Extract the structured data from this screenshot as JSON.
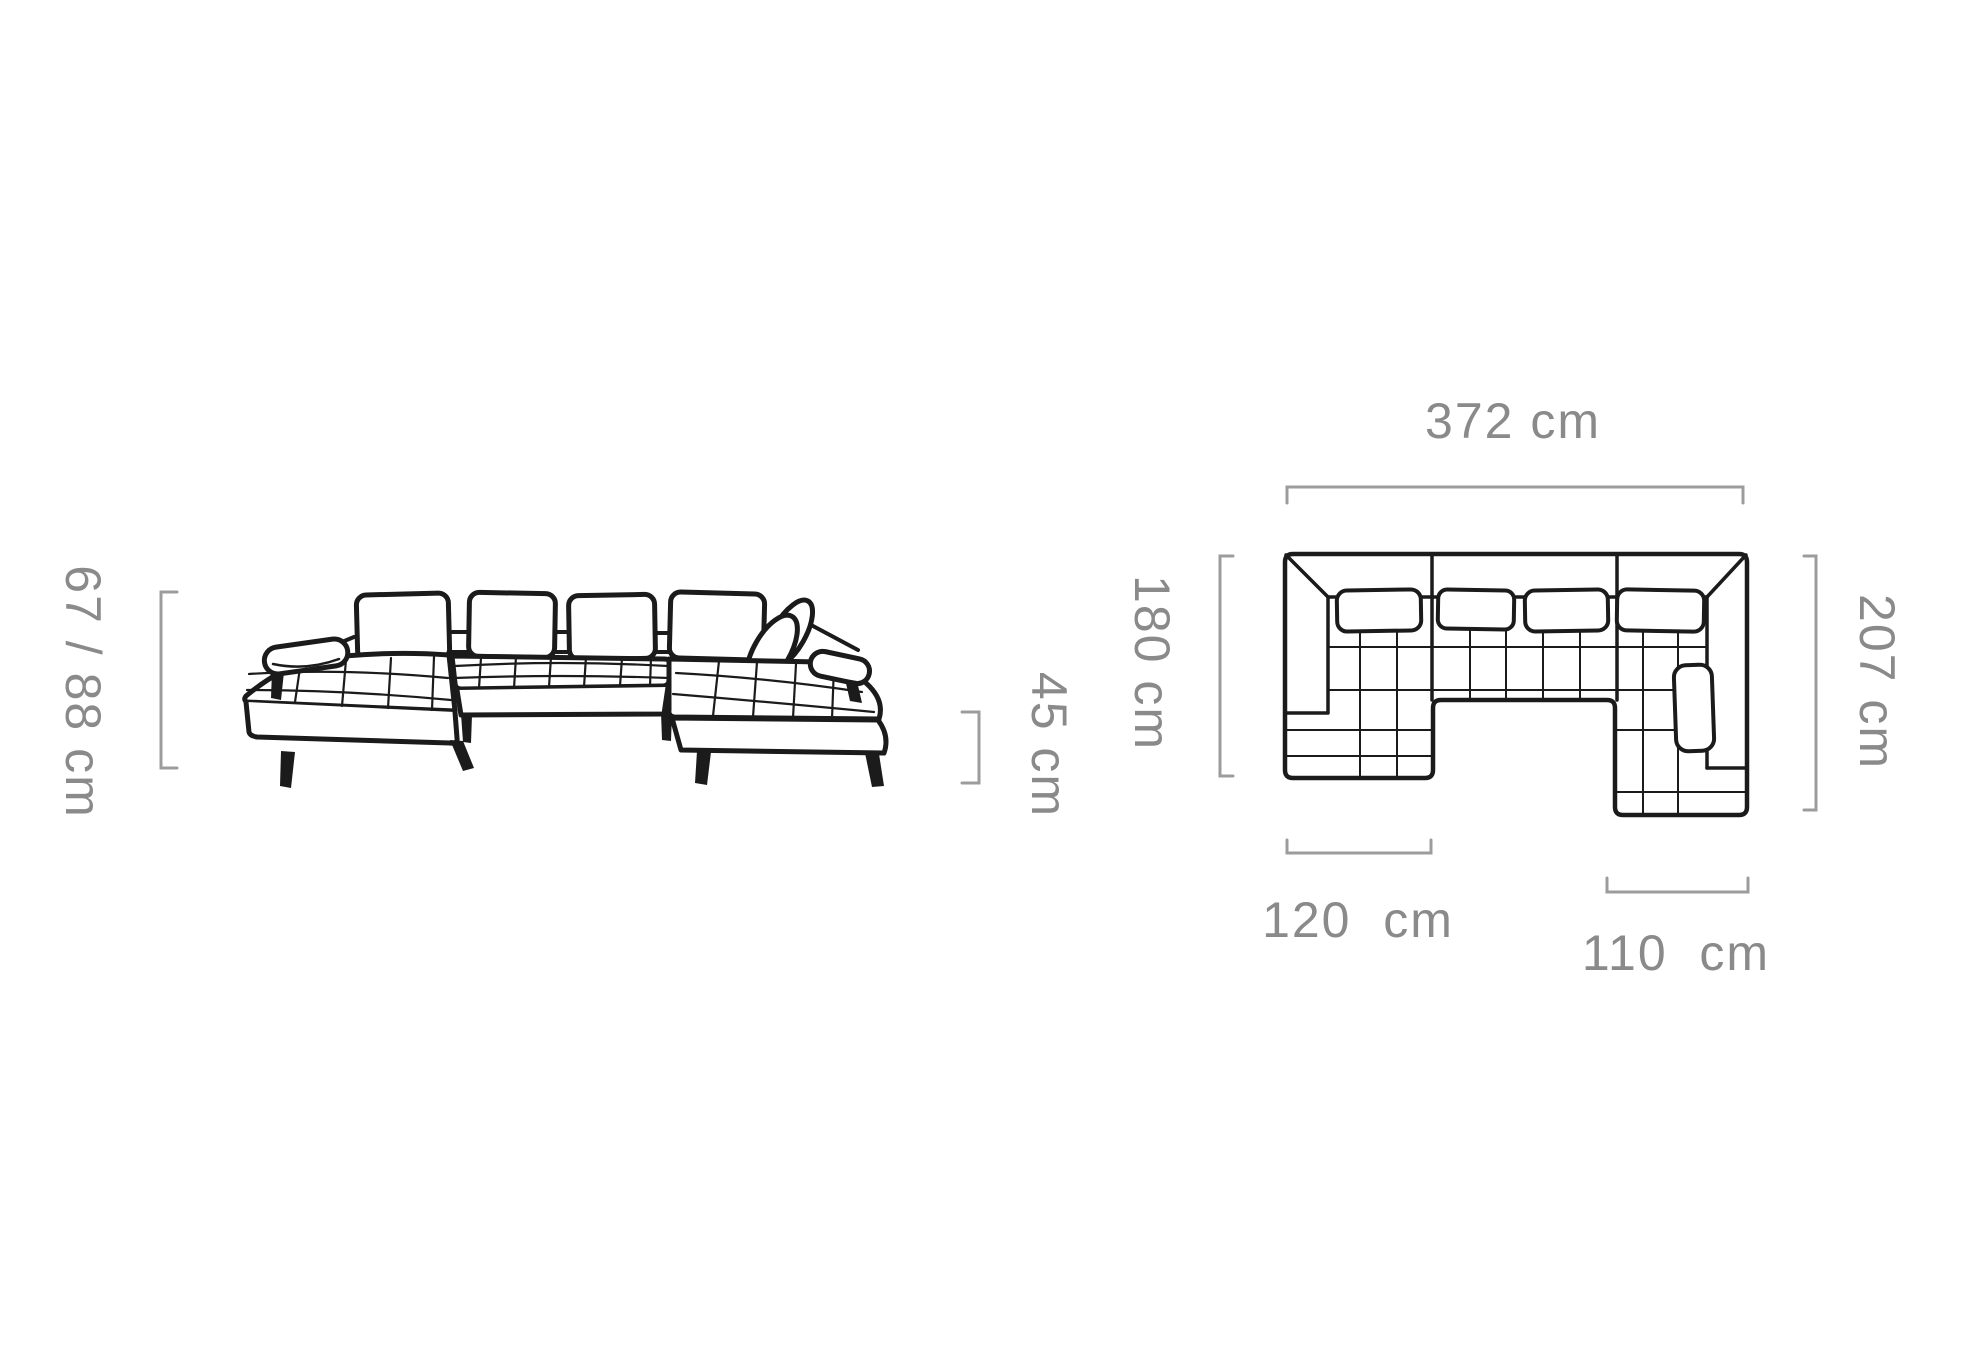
{
  "page": {
    "background": "#ffffff",
    "description": "Sectional sofa dimension diagram with front elevation and top plan views"
  },
  "colors": {
    "sofa_line": "#1b1b1b",
    "dimension_text": "#8a8a8a",
    "bracket_line": "#9c9c9c"
  },
  "front_view": {
    "name": "front-elevation",
    "labels": {
      "total_height": "67 / 88 cm",
      "seat_height": "45 cm"
    }
  },
  "plan_view": {
    "name": "top-plan",
    "labels": {
      "total_width": "372 cm",
      "left_depth": "180 cm",
      "right_depth": "207 cm",
      "left_chaise_width": "120  cm",
      "right_chaise_width": "110  cm"
    }
  }
}
